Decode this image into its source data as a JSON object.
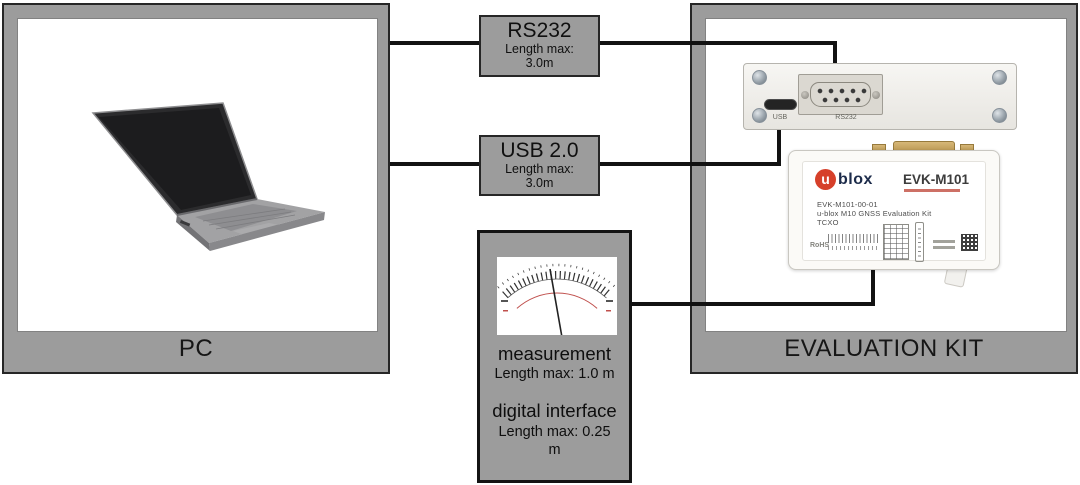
{
  "colors": {
    "box-gray": "#9c9c9c",
    "box-border": "#262626",
    "line-black": "#121212",
    "ublox-red": "#d6402a",
    "ublox-navy": "#1c2b4a",
    "meter-red": "#c0504d"
  },
  "pc": {
    "label": "PC"
  },
  "cables": {
    "rs232": {
      "title": "RS232",
      "length_label": "Length max:",
      "length_value": "3.0m"
    },
    "usb": {
      "title": "USB 2.0",
      "length_label": "Length max:",
      "length_value": "3.0m"
    }
  },
  "measurement": {
    "title": "measurement",
    "length": "Length max: 1.0 m",
    "title2": "digital interface",
    "length2_line1": "Length max: 0.25",
    "length2_line2": "m"
  },
  "evaluation_kit": {
    "label": "EVALUATION KIT",
    "adapter": {
      "usb_port_label": "USB",
      "rs232_port_label": "RS232"
    },
    "evk_board": {
      "brand_initial": "u",
      "brand_rest": "blox",
      "model": "EVK-M101",
      "part_number": "EVK-M101-00-01",
      "description": "u-blox M10 GNSS Evaluation Kit",
      "oscillator": "TCXO",
      "rohs_label": "RoHS"
    }
  }
}
